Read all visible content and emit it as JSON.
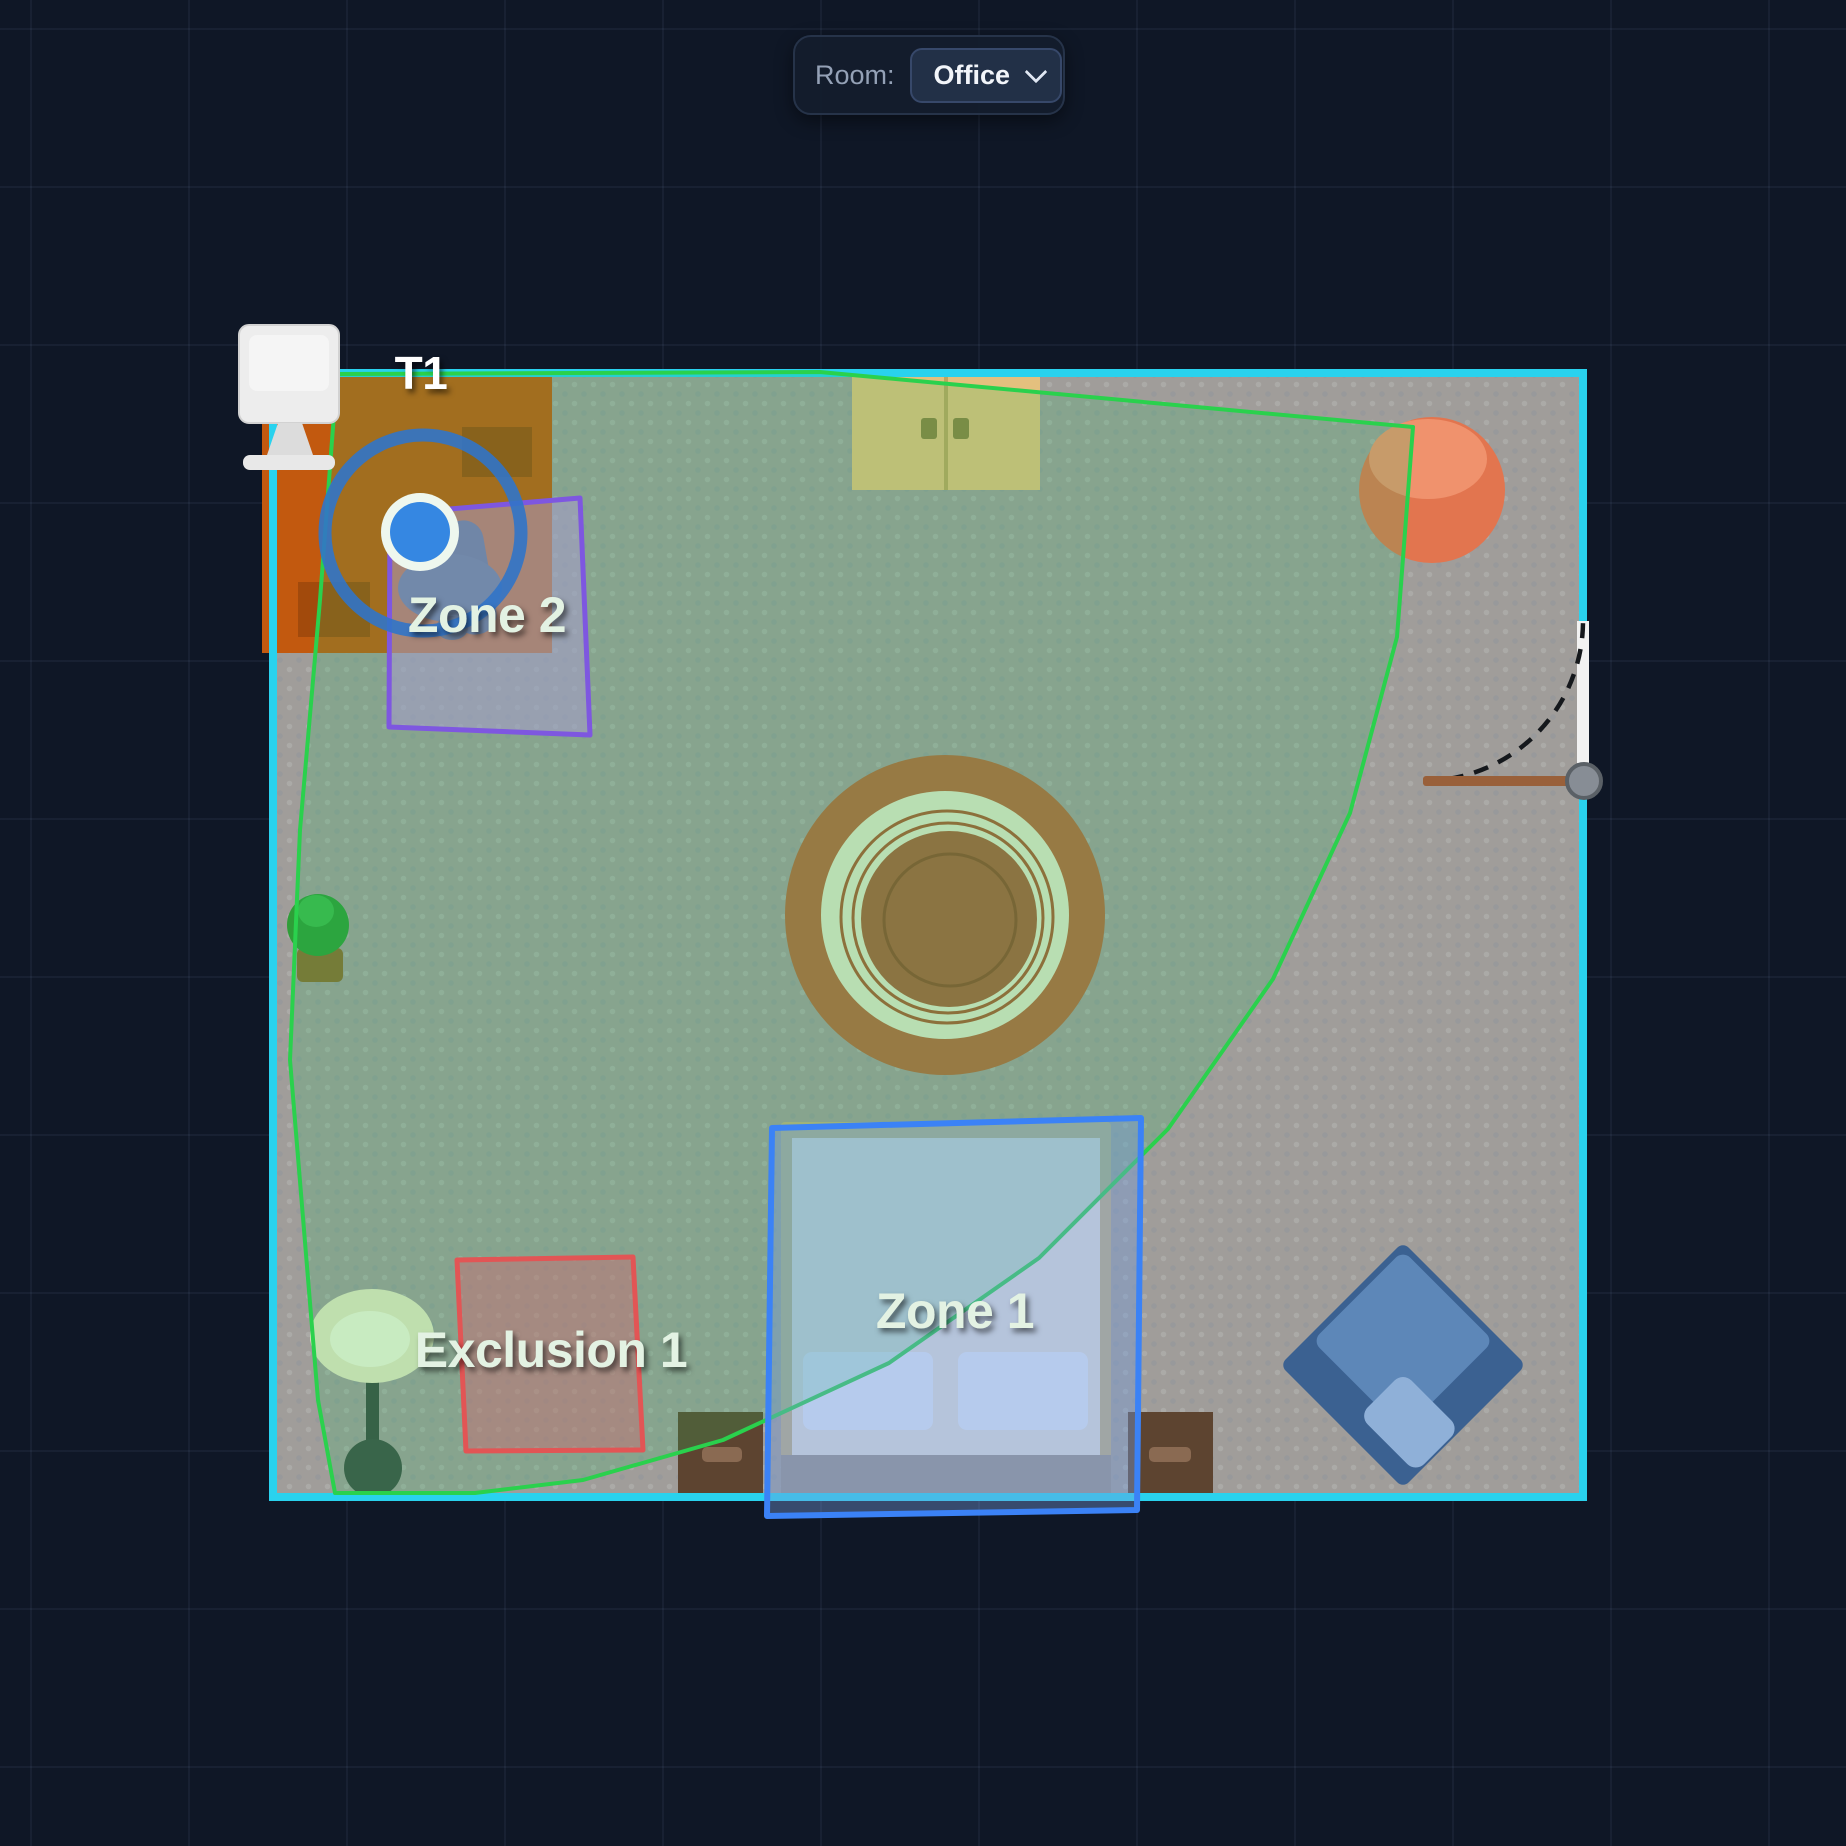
{
  "header": {
    "room_label": "Room:",
    "room_select": {
      "value": "Office",
      "icon": "chevron-down-icon"
    }
  },
  "floorplan": {
    "sensor": {
      "label": "T1",
      "color": "#3587e2",
      "ring_color": "#3174c8"
    },
    "zones": [
      {
        "label": "Zone 1",
        "kind": "detection",
        "color": "#3b82f6"
      },
      {
        "label": "Zone 2",
        "kind": "detection",
        "color": "#7e57e0"
      },
      {
        "label": "Exclusion 1",
        "kind": "exclusion",
        "color": "#e25555"
      }
    ],
    "coverage": {
      "stroke": "#2ad14d",
      "fill": "rgba(34,197,94,0.2)"
    },
    "room": {
      "wall_color": "#29d2ee",
      "floor_color": "#a09d9a"
    },
    "furniture": [
      "monitor",
      "desk",
      "desk-chair",
      "wardrobe",
      "round-rug",
      "potted-plant",
      "floor-lamp",
      "bed",
      "pillow",
      "pillow",
      "nightstand",
      "nightstand",
      "beanbag",
      "armchair",
      "door"
    ]
  }
}
